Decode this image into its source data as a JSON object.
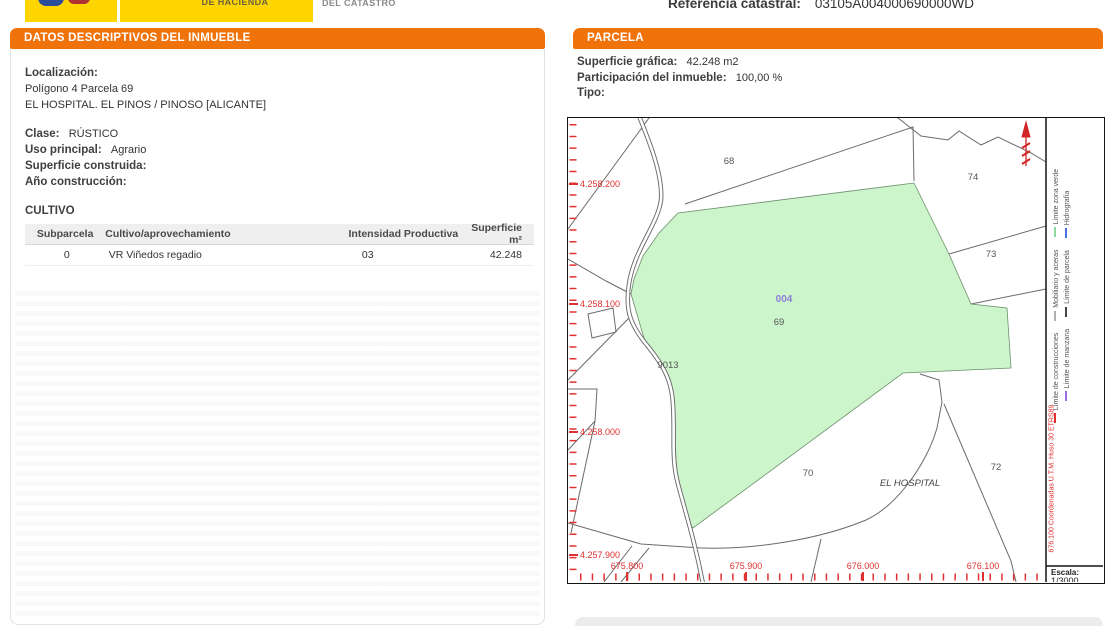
{
  "header": {
    "ministry_label": "DE HACIENDA",
    "directorate_label": "DEL CATASTRO",
    "ref_label": "Referencia catastral:",
    "ref_value": "03105A004000690000WD"
  },
  "left_panel": {
    "title": "DATOS DESCRIPTIVOS DEL INMUEBLE",
    "localizacion_label": "Localización:",
    "localizacion_line1": "Polígono 4 Parcela 69",
    "localizacion_line2": "EL HOSPITAL. EL PINOS / PINOSO [ALICANTE]",
    "clase_label": "Clase:",
    "clase_value": "RÚSTICO",
    "uso_label": "Uso principal:",
    "uso_value": "Agrario",
    "superficie_label": "Superficie construida:",
    "superficie_value": "",
    "ano_label": "Año construcción:",
    "ano_value": "",
    "cultivo_title": "CULTIVO",
    "table": {
      "headers": [
        "Subparcela",
        "Cultivo/aprovechamiento",
        "Intensidad Productiva",
        "Superficie m²"
      ],
      "rows": [
        [
          "0",
          "VR Viñedos regadio",
          "03",
          "42.248"
        ]
      ]
    }
  },
  "right_panel": {
    "title": "PARCELA",
    "superficie_label": "Superficie gráfica:",
    "superficie_value": "42.248 m2",
    "participacion_label": "Participación del inmueble:",
    "participacion_value": "100,00 %",
    "tipo_label": "Tipo:",
    "tipo_value": ""
  },
  "map": {
    "parcels": {
      "p68": "68",
      "p74": "74",
      "p73": "73",
      "p72": "72",
      "p70": "70",
      "p69": "69",
      "p004": "004",
      "p9013": "9013",
      "hospital": "EL HOSPITAL"
    },
    "y_labels": [
      "4.258.200",
      "4.258.100",
      "4.258.000",
      "4.257.900"
    ],
    "x_labels": [
      "675.800",
      "675.900",
      "676.000",
      "676.100"
    ],
    "legend": {
      "row1": [
        {
          "label": "Límite de construcciones",
          "color": "#E03030"
        },
        {
          "label": "Mobiliario y aceras",
          "color": "#B0B0B0"
        },
        {
          "label": "Límite zona verde",
          "color": "#8FD6A0"
        }
      ],
      "row2": [
        {
          "label": "Límite de manzana",
          "color": "#9B6BE8"
        },
        {
          "label": "Límite de parcela",
          "color": "#444444"
        },
        {
          "label": "Hidrografía",
          "color": "#4A6FE3"
        }
      ]
    },
    "coords_note": "676.100 Coordenadas U.T.M. Huso 30 ETRS89",
    "escala_label": "Escala:",
    "escala_value": "1/3000"
  },
  "colors": {
    "accent_orange": "#F0720B",
    "ministry_yellow": "#FFD500",
    "parcel_green": "#CDF5CB",
    "map_red": "#E03030",
    "parcel_code_purple": "#8A7FD6"
  }
}
